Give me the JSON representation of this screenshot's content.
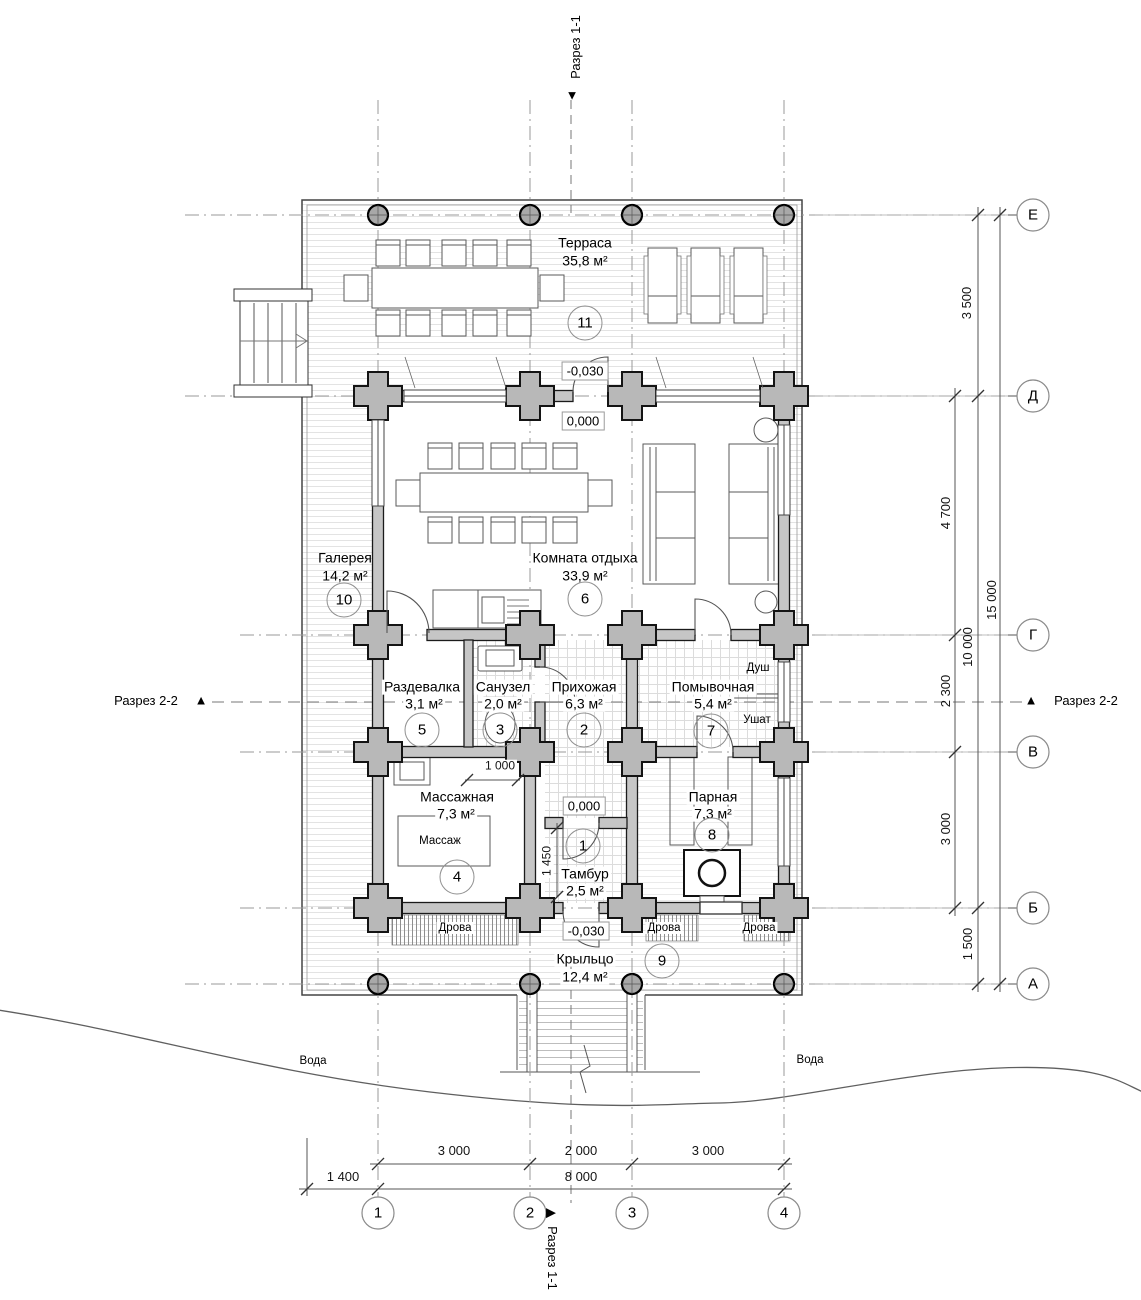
{
  "rooms": [
    {
      "number": "1",
      "name": "Тамбур",
      "area": "2,5 м²"
    },
    {
      "number": "2",
      "name": "Прихожая",
      "area": "6,3 м²"
    },
    {
      "number": "3",
      "name": "Санузел",
      "area": "2,0 м²"
    },
    {
      "number": "4",
      "name": "Массажная",
      "area": "7,3 м²"
    },
    {
      "number": "5",
      "name": "Раздевалка",
      "area": "3,1 м²"
    },
    {
      "number": "6",
      "name": "Комната отдыха",
      "area": "33,9 м²"
    },
    {
      "number": "7",
      "name": "Помывочная",
      "area": "5,4 м²"
    },
    {
      "number": "8",
      "name": "Парная",
      "area": "7,3 м²"
    },
    {
      "number": "9",
      "name": "Крыльцо",
      "area": "12,4 м²"
    },
    {
      "number": "10",
      "name": "Галерея",
      "area": "14,2 м²"
    },
    {
      "number": "11",
      "name": "Терраса",
      "area": "35,8 м²"
    }
  ],
  "levels": {
    "zero": "0,000",
    "minus_030": "-0,030"
  },
  "annotations": {
    "dush": "Душ",
    "ushat": "Ушат",
    "massazh": "Массаж",
    "drova": "Дрова",
    "voda": "Вода"
  },
  "sections": {
    "s11": "Разрез 1-1",
    "s22": "Разрез 2-2"
  },
  "icons": {
    "arrow_down": "▼",
    "arrow_up": "▲",
    "arrow_right": "▶"
  },
  "axes": {
    "vertical": [
      "Е",
      "Д",
      "Г",
      "В",
      "Б",
      "А"
    ],
    "horizontal": [
      "1",
      "2",
      "3",
      "4"
    ]
  },
  "dimensions": {
    "right_inner": [
      "4 700",
      "2 300",
      "3 000"
    ],
    "right_middle": [
      "3 500",
      "10 000",
      "1 500"
    ],
    "right_overall": "15 000",
    "bottom_segments": [
      "3 000",
      "2 000",
      "3 000"
    ],
    "bottom_offset": "1 400",
    "bottom_overall": "8 000",
    "partition": "1 000",
    "tambour_depth": "1 450"
  },
  "colors": {
    "wall_fill": "#c6c6c6",
    "joint_fill": "#b8b8b8",
    "line": "#555555",
    "grid": "#9a9a9a"
  }
}
